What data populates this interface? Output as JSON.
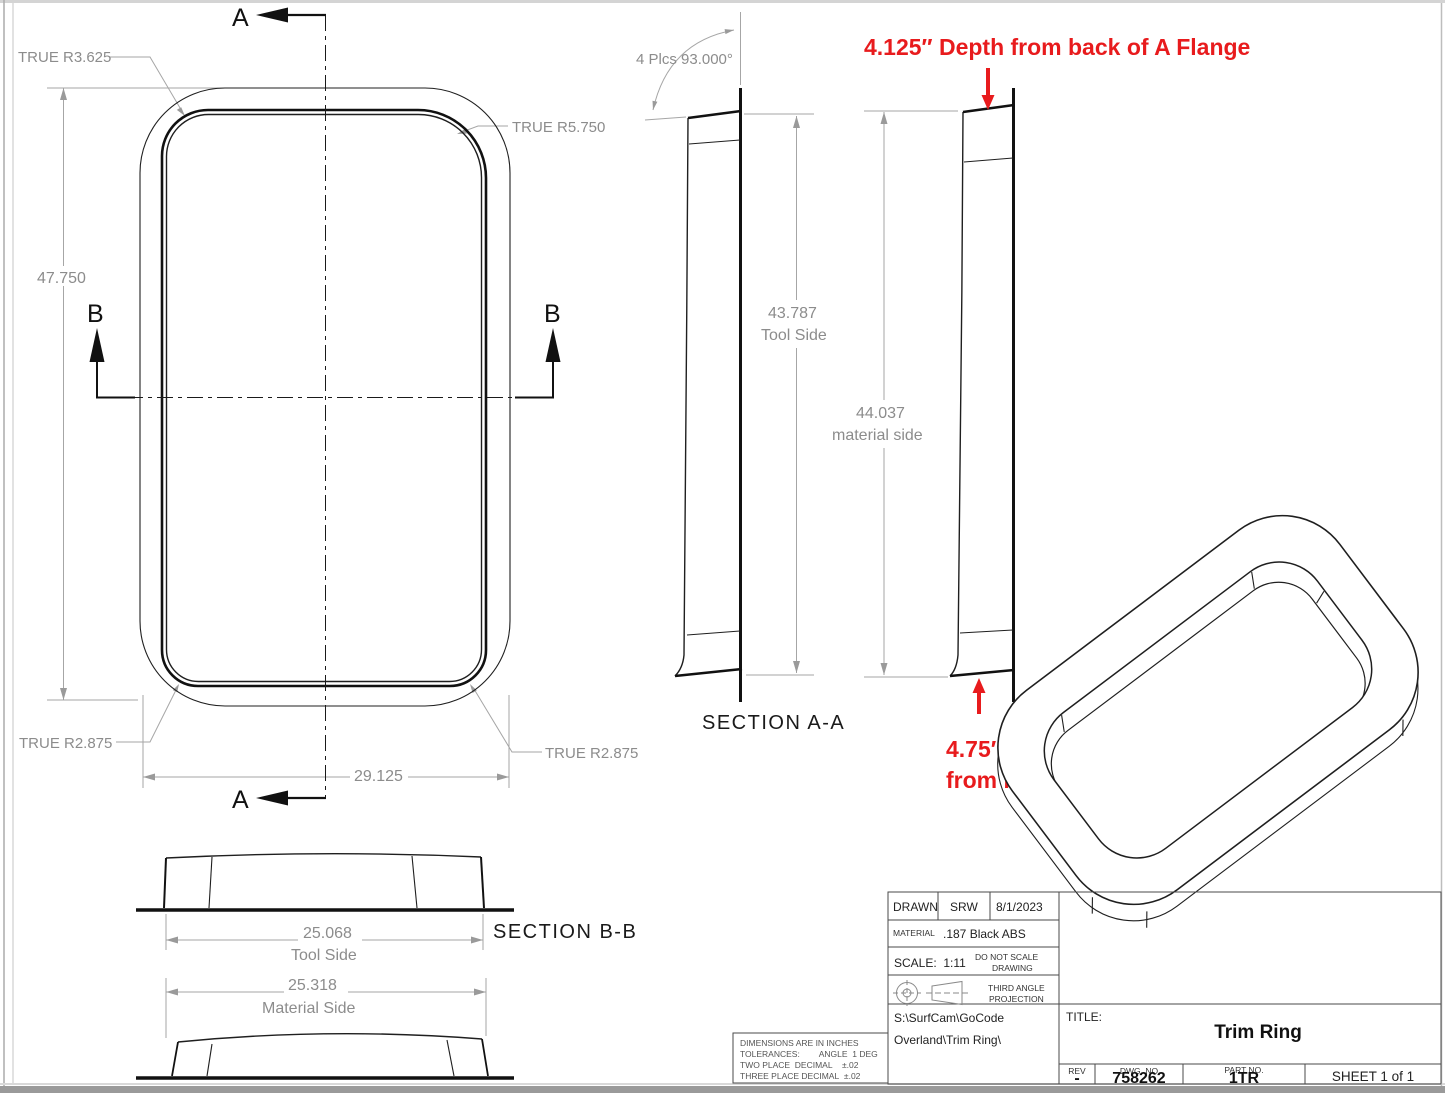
{
  "colors": {
    "annotation_red": "#e81b1d",
    "dimension_gray": "#8c8c8c",
    "line_black": "#1a1a1a"
  },
  "front_view": {
    "labels": {
      "r_top_left": "TRUE R3.625",
      "r_top_right": "TRUE R5.750",
      "r_bottom_left": "TRUE R2.875",
      "r_bottom_right": "TRUE R2.875"
    },
    "dims": {
      "height": "47.750",
      "width": "29.125"
    },
    "marker_a": "A",
    "marker_b": "B"
  },
  "section_aa": {
    "label": "SECTION A-A",
    "angle_note": "4 Plcs 93.000°",
    "tool_value": "43.787",
    "tool_caption": "Tool Side",
    "material_value": "44.037",
    "material_caption": "material side"
  },
  "section_bb": {
    "label": "SECTION B-B",
    "tool_value": "25.068",
    "tool_caption": "Tool Side",
    "material_value": "25.318",
    "material_caption": "Material Side"
  },
  "annotations": {
    "depth_top": "4.125″ Depth from back of A Flange",
    "depth_bottom_line1": "4.75″ Depth",
    "depth_bottom_line2": "from back of A Flange"
  },
  "title_block": {
    "drawn_label": "DRAWN",
    "drawn_by": "SRW",
    "drawn_date": "8/1/2023",
    "material_label": "MATERIAL",
    "material": ".187 Black ABS",
    "scale": "SCALE:  1:11",
    "no_scale_1": "DO NOT SCALE",
    "no_scale_2": "DRAWING",
    "projection_1": "THIRD ANGLE",
    "projection_2": "PROJECTION",
    "path_1": "S:\\SurfCam\\GoCode",
    "path_2": "Overland\\Trim Ring\\",
    "title_label": "TITLE:",
    "title": "Trim Ring",
    "rev_label": "REV",
    "rev": "-",
    "dwg_label": "DWG. NO",
    "dwg_no": "758262",
    "part_label": "PART NO.",
    "part_no": "1TR",
    "sheet": "SHEET 1 of 1"
  },
  "tolerance_block": {
    "line1": "DIMENSIONS ARE IN INCHES",
    "line2": "TOLERANCES:        ANGLE  1 DEG",
    "line3": "TWO PLACE  DECIMAL    ±.02",
    "line4": "THREE PLACE DECIMAL  ±.02"
  }
}
